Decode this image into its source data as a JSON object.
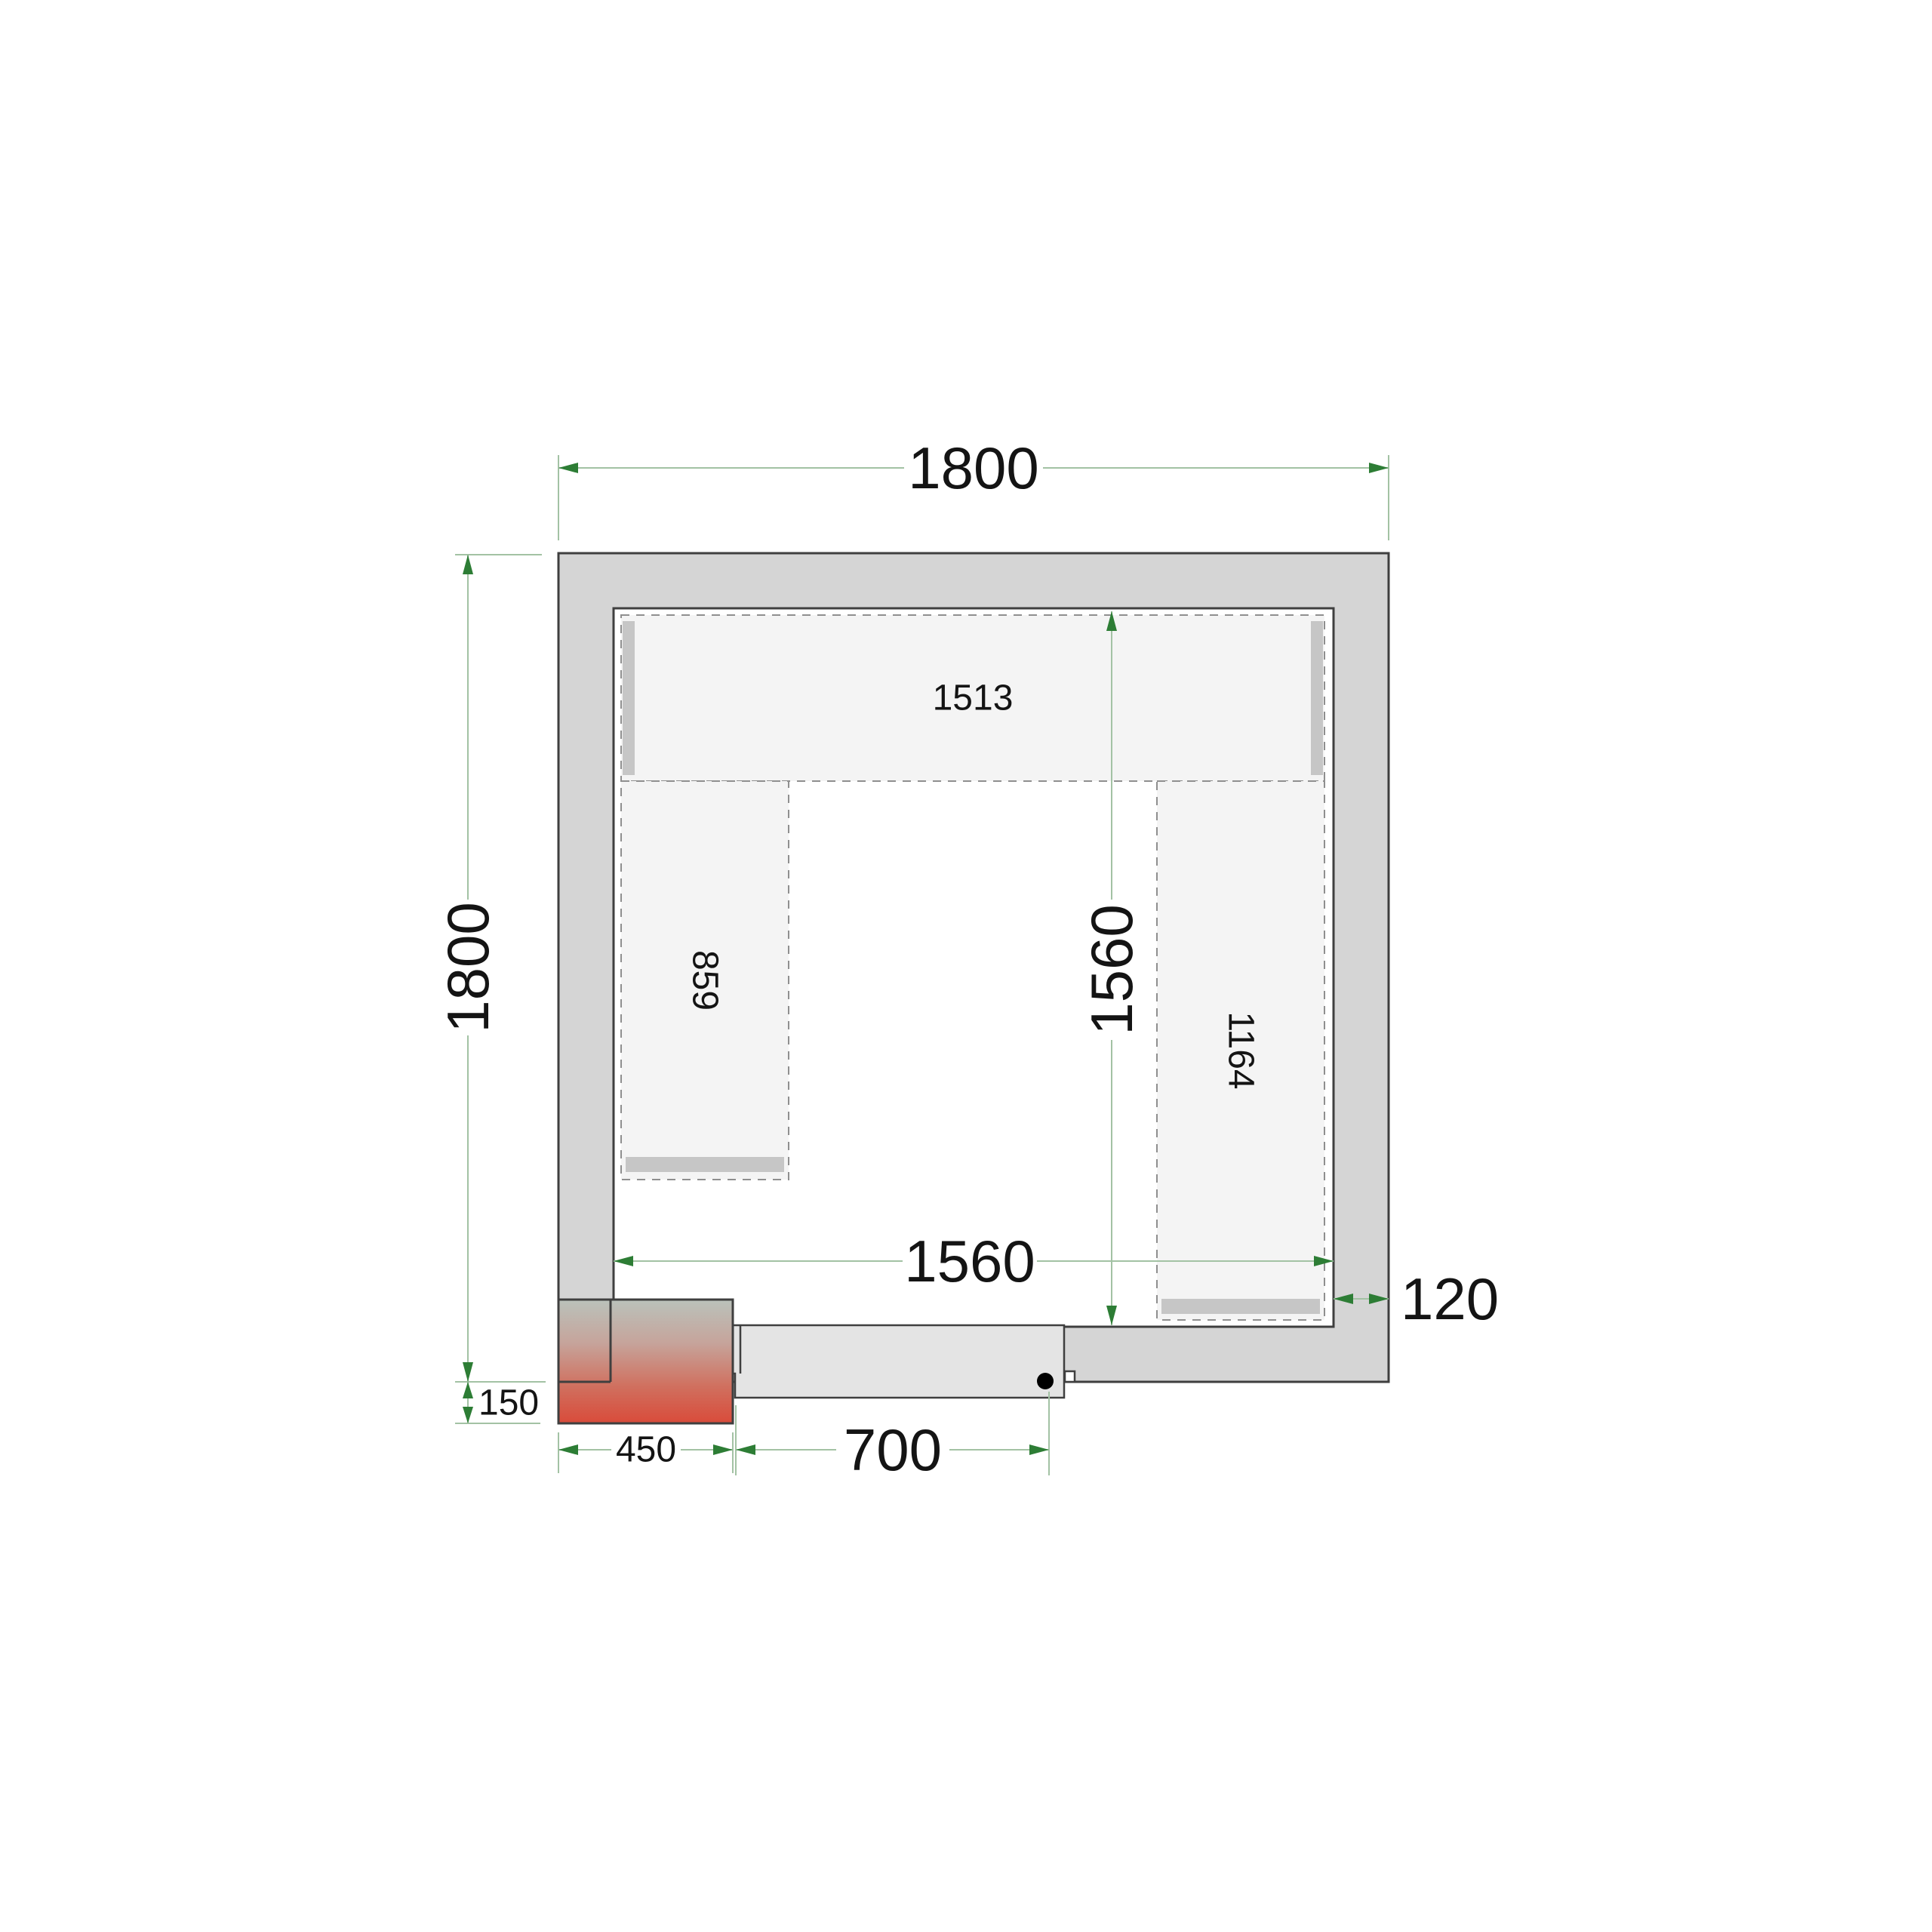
{
  "diagram": {
    "title": "cold-room floor plan (top view)",
    "units": "mm",
    "dimensions": {
      "outer_width": "1800",
      "outer_depth": "1800",
      "inner_width": "1560",
      "inner_depth": "1560",
      "wall_thickness": "120",
      "door_opening": "700",
      "unit_width": "450",
      "unit_offset": "150"
    },
    "shelves": {
      "top_length": "1513",
      "left_length": "859",
      "right_length": "1164"
    }
  },
  "colors": {
    "wall_fill": "#d5d5d5",
    "floor_fill": "#ffffff",
    "outline": "#3f3f3f",
    "shelf_fill": "#f4f4f4",
    "shelf_border": "#8f8f8f",
    "shelf_support": "#c6c6c6",
    "door_fill": "#e4e4e4",
    "hinge_dot": "#000000",
    "dimension_line": "#a3c2a4",
    "dimension_arrow": "#2d7d35",
    "unit_gradient": [
      "#bac2bb",
      "#c6a49b",
      "#d0705f",
      "#d94b3a"
    ]
  }
}
